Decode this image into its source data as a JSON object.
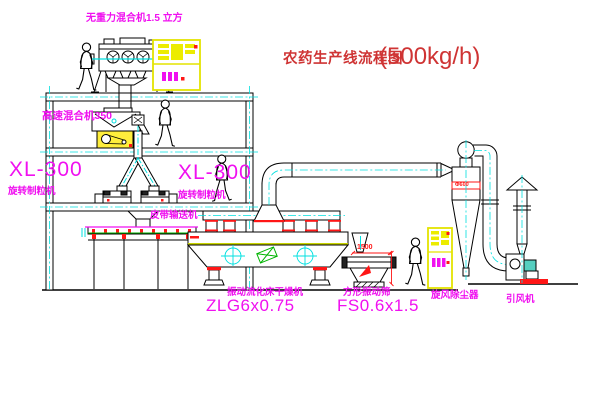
{
  "diagram": {
    "title": {
      "text": "农药生产线流程图",
      "capacity": "(500kg/h)"
    },
    "labels": {
      "top_mixer": "无重力混合机1.5 立方",
      "high_speed_mixer": "高速混合机350",
      "granulator_left_model": "XL-300",
      "granulator_left_name": "旋转制粒机",
      "granulator_right_model": "XL-300",
      "granulator_right_name": "旋转制粒机",
      "belt_conveyor": "皮带输送机",
      "dryer_name": "振动流化床干燥机",
      "dryer_model": "ZLG6x0.75",
      "sieve_name": "方形振动筛",
      "sieve_model": "FS0.6x1.5",
      "cyclone": "旋风除尘器",
      "fan": "引风机"
    },
    "dimensions": {
      "sieve_width": "1500",
      "cyclone_diameter": "Φ600"
    },
    "colors": {
      "label_magenta": "#f010f0",
      "title_red": "#cf3434",
      "centerline_cyan": "#00e0e0",
      "cabinet_yellow": "#ecec00",
      "accent_red": "#ff1616",
      "machine_green": "#00b400",
      "deck_yellow_green": "#c8d400"
    }
  }
}
